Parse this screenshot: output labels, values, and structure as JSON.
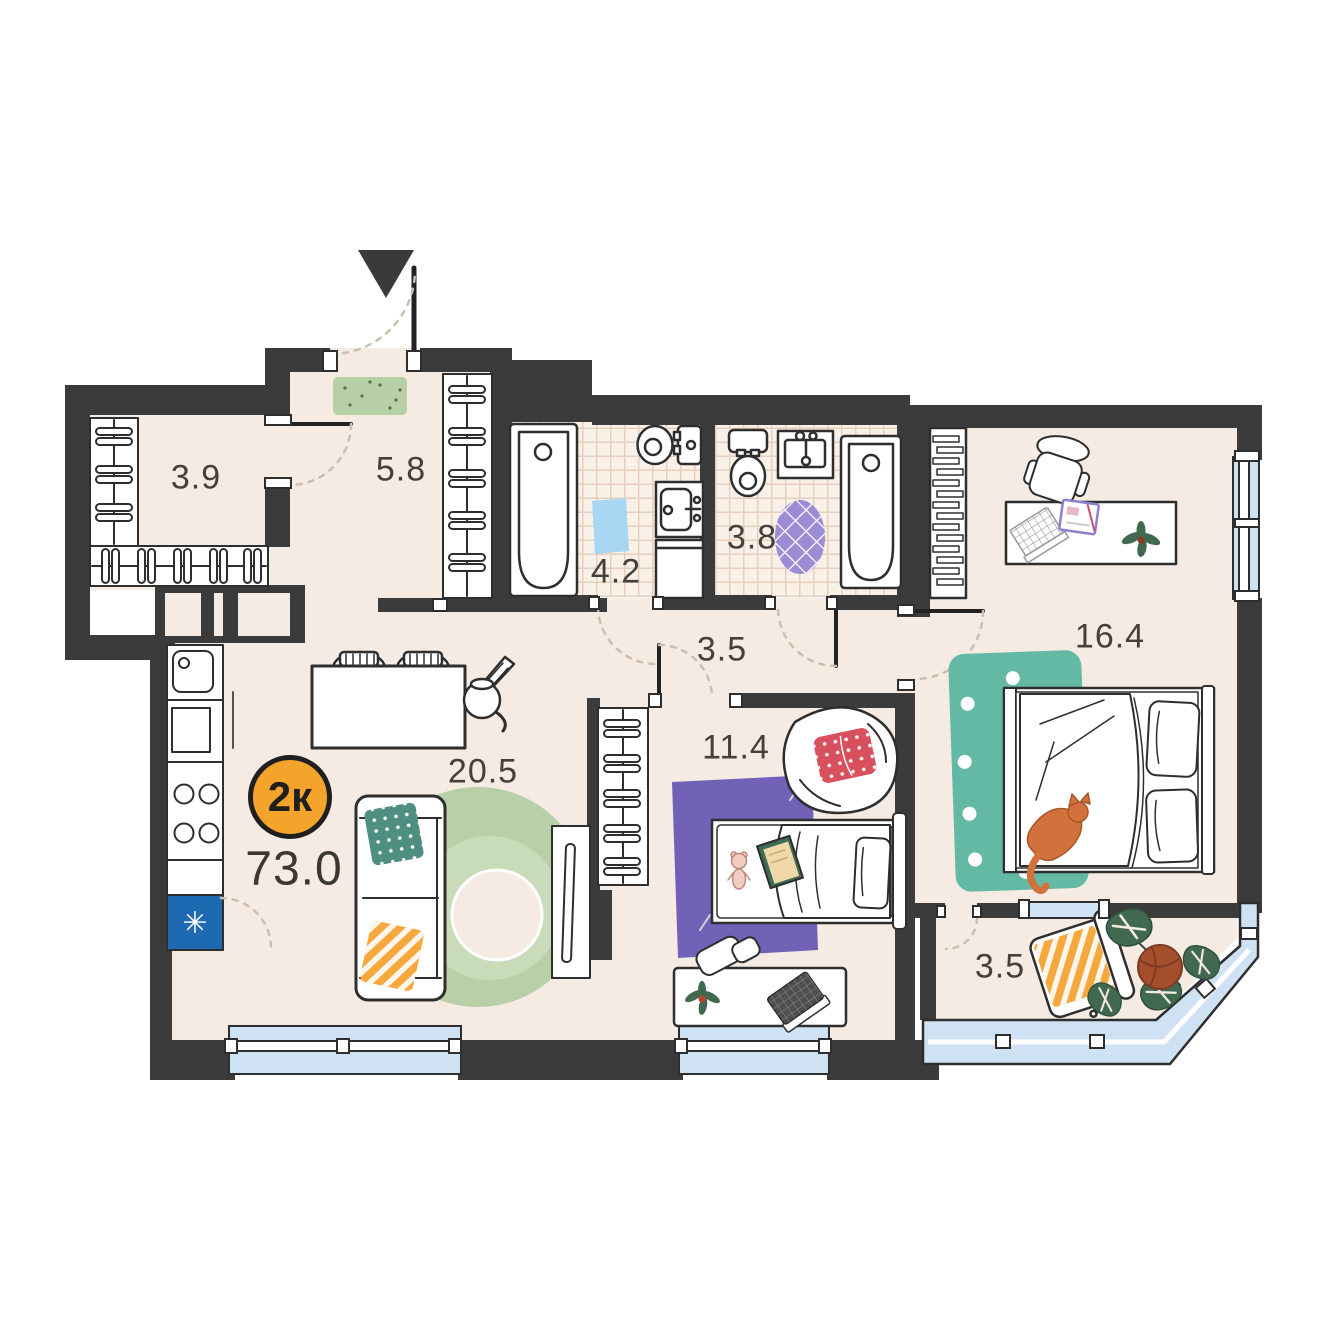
{
  "plan": {
    "title": "Apartment floor plan",
    "type_badge": {
      "label": "2к"
    },
    "total_area": "73.0",
    "rooms": [
      {
        "name": "wardrobe",
        "area": "3.9"
      },
      {
        "name": "hallway",
        "area": "5.8"
      },
      {
        "name": "bathroom",
        "area": "4.2"
      },
      {
        "name": "toilet",
        "area": "3.8"
      },
      {
        "name": "corridor",
        "area": "3.5"
      },
      {
        "name": "living-kitchen",
        "area": "20.5"
      },
      {
        "name": "kids-room",
        "area": "11.4"
      },
      {
        "name": "bedroom",
        "area": "16.4"
      },
      {
        "name": "balcony",
        "area": "3.5"
      }
    ],
    "icons": {
      "fridge_snowflake": "✳"
    },
    "colors": {
      "wall": "#3B3B3B",
      "floor": "#F5EBE2",
      "tile_bg": "#F9F1E8",
      "tile_line": "#E6CFBD",
      "window": "#CFE2F4",
      "badge": "#F5A42B",
      "fridge": "#1D6AB2",
      "mat_green": "#B7CFA7",
      "mat_blue": "#A9D6F2",
      "rug_lilac": "#9C8BD5",
      "rug_purple": "#7162B8",
      "rug_teal": "#63B9A4",
      "rug_green": "#B7D0A8",
      "rug_green_light": "#C9DCBA",
      "pillow_teal": "#4F8F82",
      "pillow_orange": "#F6A83C",
      "pillow_red": "#D8505E",
      "cat": "#D2713B",
      "plant": "#41694F",
      "pot": "#A34F2C",
      "arc": "#CDBEB0"
    }
  }
}
